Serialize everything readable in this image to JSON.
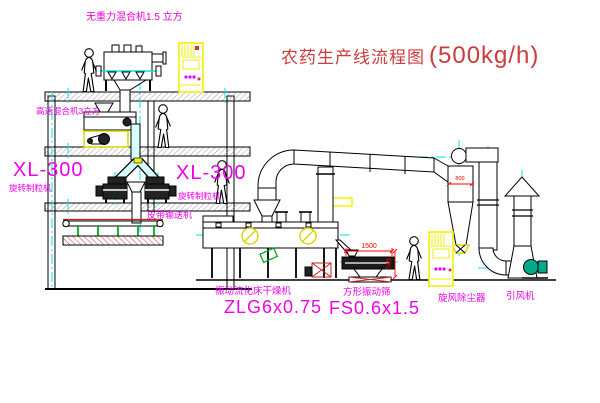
{
  "title": {
    "text": "农药生产线流程图",
    "capacity": "(500kg/h)"
  },
  "labels": {
    "gravity_mixer": "无重力混合机1.5 立方",
    "high_speed_mixer": "高速混合机3立方",
    "granulator_left": {
      "model": "XL-300",
      "name": "旋转制粒机"
    },
    "granulator_right": {
      "model": "XL-300",
      "name": "旋转制粒机"
    },
    "belt_conveyor": "皮带输送机",
    "dryer": {
      "name": "振动流化床干燥机",
      "model": "ZLG6x0.75"
    },
    "screen": {
      "name": "方形振动筛",
      "model": "FS0.6x1.5"
    },
    "cyclone": "旋风除尘器",
    "fan": "引风机"
  },
  "dimensions": {
    "screen_length": "1500",
    "screen_side": "745",
    "cyclone_width": "800"
  },
  "colors": {
    "line": "#000000",
    "centerline": "#00e6e6",
    "highlight": "#f2f200",
    "label": "#ee00ee",
    "dimension": "#ff0000",
    "title": "#cd3c3c",
    "fan_green": "#00aa88"
  }
}
